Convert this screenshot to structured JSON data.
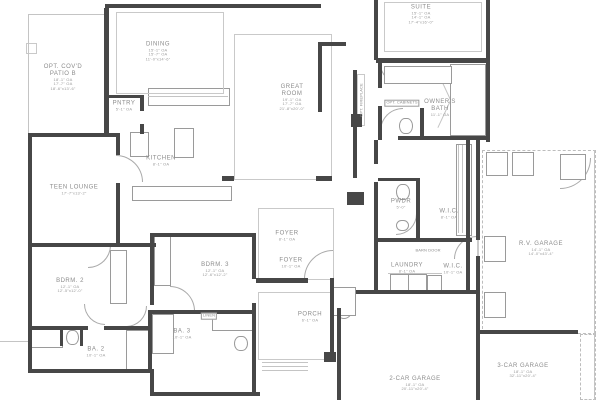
{
  "drawing": {
    "title": "residential floor plan",
    "background_color": "#ffffff",
    "wall_color": "#474747",
    "thin_line_color": "#c4c4c4",
    "text_color": "#8c8c8c"
  },
  "rooms": {
    "patio": {
      "lines": [
        "OPT. COV'D",
        "PATIO B",
        "18'-1\" OA",
        "17'-7\" OA",
        "18'-6\"x13'-6\""
      ]
    },
    "dining": {
      "lines": [
        "DINING",
        "15'-1\" OA",
        "15'-7\" OA",
        "11'-0\"x14'-6\""
      ]
    },
    "great_room": {
      "lines": [
        "GREAT",
        "ROOM",
        "19'-1\" OA",
        "17'-7\" OA",
        "21'-8\"x20'-0\""
      ]
    },
    "suite": {
      "lines": [
        "SUITE",
        "15'-1\" OA",
        "14'-1\" OA",
        "17'-4\"x16'-0\""
      ]
    },
    "owners_bath": {
      "lines": [
        "OWNER'S",
        "BATH",
        "11'-1\" OA"
      ]
    },
    "pantry": {
      "lines": [
        "PNTRY",
        "5'-1\" OA"
      ]
    },
    "kitchen": {
      "lines": [
        "KITCHEN",
        "8'-1\" OA"
      ]
    },
    "teen_lounge": {
      "lines": [
        "TEEN  LOUNGE",
        "17'-7\"x13'-2\""
      ]
    },
    "foyer_upper": {
      "lines": [
        "FOYER",
        "8'-1\" OA"
      ]
    },
    "foyer_lower": {
      "lines": [
        "FOYER",
        "10'-1\" OA"
      ]
    },
    "pwdr": {
      "lines": [
        "PWDR",
        "5'-0\""
      ]
    },
    "wic_upper": {
      "lines": [
        "W.I.C.",
        "8'-1\" OA"
      ]
    },
    "laundry": {
      "lines": [
        "LAUNDRY",
        "8'-1\" OA"
      ]
    },
    "wic_lower": {
      "lines": [
        "W.I.C.",
        "10'-1\" OA"
      ]
    },
    "bdrm2": {
      "lines": [
        "BDRM. 2",
        "12'-1\" OA",
        "12'-5\"x12'-0\""
      ]
    },
    "bdrm3": {
      "lines": [
        "BDRM. 3",
        "12'-1\" OA",
        "12'-6\"x12'-2\""
      ]
    },
    "ba2": {
      "lines": [
        "BA. 2",
        "10'-1\" OA"
      ]
    },
    "ba3": {
      "lines": [
        "BA. 3",
        "10'-1\" OA"
      ]
    },
    "linen": {
      "lines": [
        "LINEN"
      ]
    },
    "porch": {
      "lines": [
        "PORCH",
        "6'-1\" OA"
      ]
    },
    "garage2": {
      "lines": [
        "2-CAR  GARAGE",
        "18'-1\" OA",
        "20'-11\"x20'-4\""
      ]
    },
    "garage3": {
      "lines": [
        "3-CAR  GARAGE",
        "18'-1\" OA",
        "32'-11\"x20'-4\""
      ]
    },
    "rv_garage": {
      "lines": [
        "R.V.  GARAGE",
        "14'-1\" OA",
        "14'-0\"x43'-4\""
      ]
    },
    "opt_fireplace": {
      "lines": [
        "OPT. FIREPLACE"
      ]
    },
    "opt_cabinets": {
      "lines": [
        "OPT. CABINETS"
      ]
    },
    "barn_door": {
      "lines": [
        "BARN DOOR"
      ]
    }
  }
}
